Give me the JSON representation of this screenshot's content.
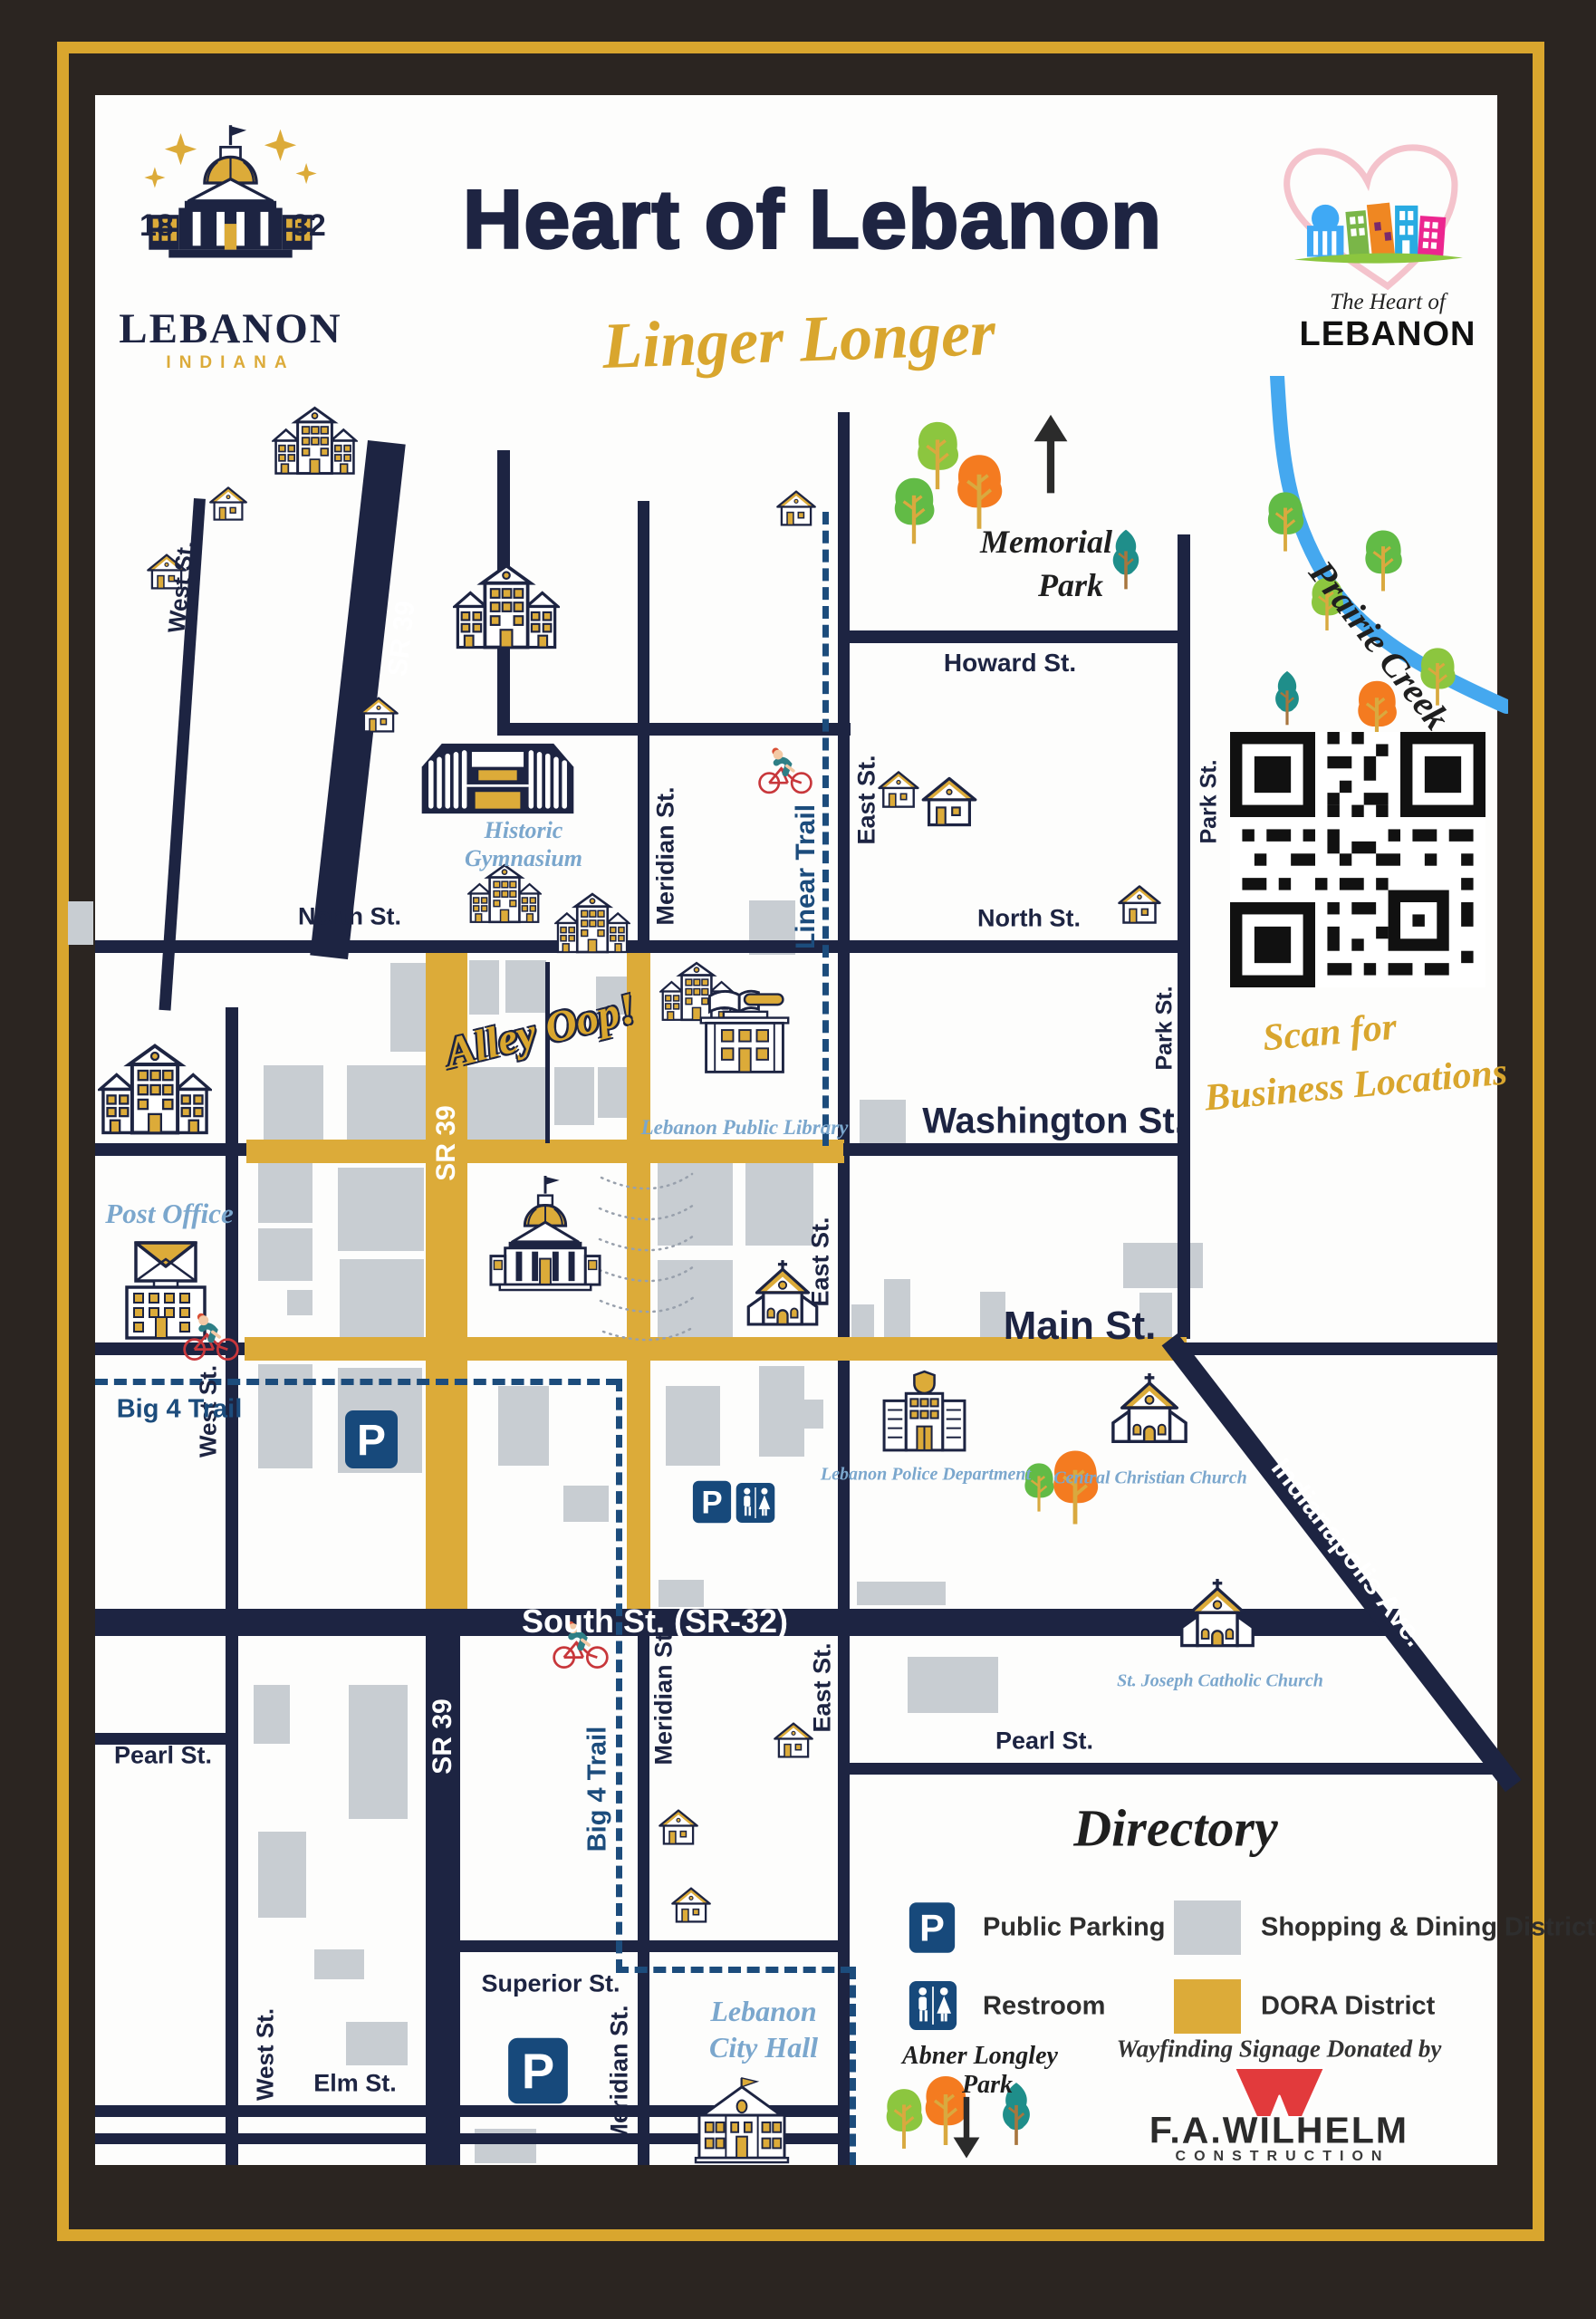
{
  "header": {
    "title": "Heart of Lebanon",
    "tagline": "Linger Longer",
    "city_logo": {
      "year_left": "18",
      "year_right": "32",
      "name": "LEBANON",
      "state": "INDIANA"
    },
    "heart_logo": {
      "line1": "The Heart of",
      "line2": "LEBANON"
    }
  },
  "streets": {
    "west": "West St.",
    "sr39": "SR 39",
    "meridian": "Meridian St.",
    "east": "East St.",
    "park": "Park St.",
    "north": "North St.",
    "howard": "Howard St.",
    "washington": "Washington St.",
    "main": "Main St.",
    "south": "South St. (SR-32)",
    "pearl": "Pearl St.",
    "superior": "Superior St.",
    "elm": "Elm St.",
    "indianapolis": "Indianapolis Ave."
  },
  "trails": {
    "linear": "Linear Trail",
    "big4": "Big 4 Trail"
  },
  "water": {
    "prairie_creek": "Prairie Creek"
  },
  "parks": {
    "memorial": {
      "line1": "Memorial",
      "line2": "Park"
    },
    "abner": {
      "line1": "Abner Longley",
      "line2": "Park"
    }
  },
  "pois": {
    "gym": {
      "line1": "Historic",
      "line2": "Gymnasium"
    },
    "library": "Lebanon Public Library",
    "post_office": "Post Office",
    "police": "Lebanon Police Department",
    "central_church": "Central Christian Church",
    "st_joseph": "St. Joseph Catholic Church",
    "city_hall": {
      "line1": "Lebanon",
      "line2": "City Hall"
    },
    "alley": "Alley Oop!"
  },
  "qr": {
    "caption_line1": "Scan for",
    "caption_line2": "Business Locations"
  },
  "directory": {
    "title": "Directory",
    "parking": "Public Parking",
    "restroom": "Restroom",
    "shopping": "Shopping & Dining District",
    "dora": "DORA District"
  },
  "sponsor": {
    "intro": "Wayfinding Signage Donated by",
    "name": "F.A.WILHELM",
    "sub": "CONSTRUCTION"
  },
  "colors": {
    "navy": "#1d2442",
    "dora_gold": "#dcab39",
    "district_gray": "#c8cdd2",
    "trail_blue": "#1c4c7c",
    "creek_blue": "#45a8ef",
    "script_blue": "#7ba7cd",
    "frame_gold": "#d9a62e",
    "frame_dark": "#2b2521",
    "wilhelm_red": "#e23a3c"
  }
}
